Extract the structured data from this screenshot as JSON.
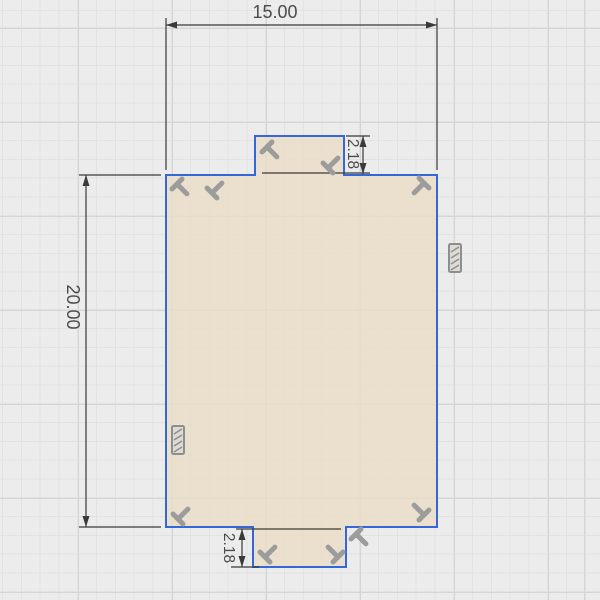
{
  "colors": {
    "canvas-bg": "#ececec",
    "grid-minor": "#e2e2e2",
    "grid-major": "#d5d5d5",
    "profile-fill": "rgba(234,221,198,0.8)",
    "profile-stroke": "#3468d9",
    "dim-line": "#3a3a3a",
    "dim-text": "#4c4c4c",
    "constraint": "#9c9c9c",
    "fix-fill": "#dedbd4",
    "fix-stroke": "#8e8e8e"
  },
  "dimensions": {
    "width": {
      "label": "15.00"
    },
    "height": {
      "label": "20.00"
    },
    "tab_top": {
      "label": "2.18"
    },
    "tab_bottom": {
      "label": "2.18"
    }
  },
  "icons": {
    "perpendicular-constraint-icon": "gray rotated-T glyph (perpendicular sketch constraint)",
    "fix-constraint-icon": "gray hatched rectangle (fix/ground sketch constraint)",
    "dimension-arrowhead": "filled triangle arrow on dimension line"
  }
}
